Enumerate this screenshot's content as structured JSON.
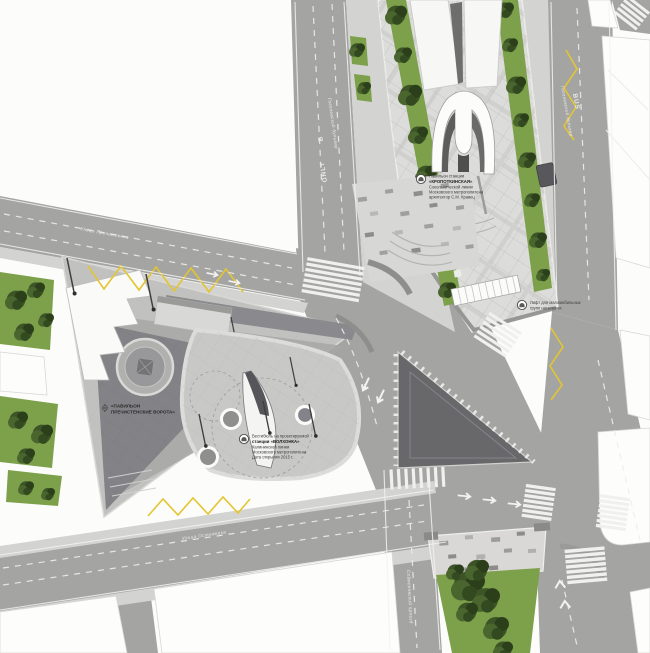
{
  "annotations": {
    "kropotkinskaya": {
      "icon": "metro-arch-icon",
      "lines": [
        "Павильон станции",
        "«КРОПОТКИНСКАЯ»",
        "Сокольнической линии",
        "Московского метрополитена",
        "архитектор С.М. Кравец"
      ]
    },
    "lift": {
      "icon": "metro-arch-icon",
      "lines": [
        "Лифт для маломобильных",
        "групп населения"
      ]
    },
    "pavilion": {
      "icon": "diamond-marker-icon",
      "lines": [
        "«ПАВИЛЬОН",
        "ПРЕЧИСТЕНСКИЕ ВОРОТА»"
      ]
    },
    "volkhonka": {
      "icon": "metro-arch-icon",
      "lines": [
        "Вестибюль на проектируемой",
        "станции «ВОЛХОНКА»",
        "Калининской линии",
        "Московского метрополитена",
        "Дата открытия 2015 г."
      ]
    }
  },
  "streets": {
    "prechistenka": "Улица Пречистенка",
    "ostozhenka": "Улица Остоженка",
    "gogolevsky": "Гоголевский бульвар",
    "soymonovsky": "Соймоновский проезд"
  },
  "road_markings": {
    "bus": "BUS",
    "only": "ONLY",
    "lane_letter": "B"
  },
  "colors": {
    "asphalt": "#a4a4a2",
    "sidewalk": "#d3d3d1",
    "plaza_light": "#dcdcda",
    "plaza_dark": "#68686a",
    "green": "#7da04a",
    "tree": "#33491f",
    "warning_yellow": "#e3c531",
    "building": "#fdfdfb",
    "marking_white": "#f0f0ee",
    "annotation_text": "#3c3c3c"
  }
}
